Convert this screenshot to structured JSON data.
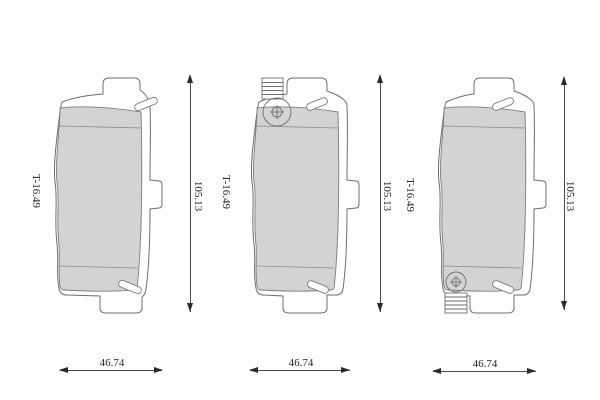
{
  "drawing": {
    "title": "brake-pad-set-technical-drawing",
    "colors": {
      "background": "#ffffff",
      "friction_fill": "#d3d3d3",
      "outline": "#6e6e6e",
      "dimension_text": "#1f1f1f"
    },
    "views": [
      {
        "name": "left-pad",
        "thickness_label": "T-16.49",
        "height_dim": "105.13",
        "width_dim": "46.74",
        "wear_indicator": "none"
      },
      {
        "name": "middle-pad",
        "thickness_label": "T-16.49",
        "height_dim": "105.13",
        "width_dim": "46.74",
        "wear_indicator": "top-left"
      },
      {
        "name": "right-pad",
        "thickness_label": "T-16.49",
        "height_dim": "105.13",
        "width_dim": "46.74",
        "wear_indicator": "bottom-left"
      }
    ]
  }
}
